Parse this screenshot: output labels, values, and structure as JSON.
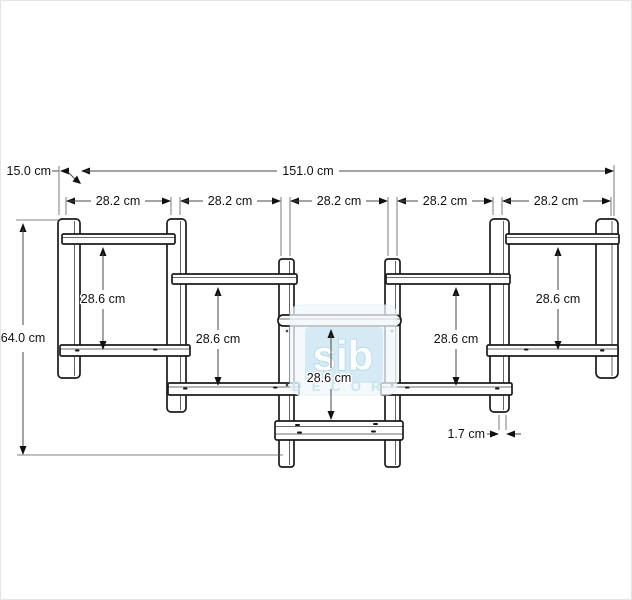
{
  "drawing": {
    "dimensions": {
      "total_width": "151.0 cm",
      "depth": "15.0 cm",
      "total_height": "64.0 cm",
      "panel_thickness": "1.7 cm",
      "section_widths": [
        "28.2 cm",
        "28.2 cm",
        "28.2 cm",
        "28.2 cm",
        "28.2 cm"
      ],
      "section_heights": [
        "28.6 cm",
        "28.6 cm",
        "28.6 cm",
        "28.6 cm",
        "28.6 cm"
      ]
    },
    "watermark": {
      "brand": "sib",
      "word": "DECOR"
    },
    "colors": {
      "line": "#1b1b1b",
      "watermark_blue": "#cde6f1"
    }
  }
}
